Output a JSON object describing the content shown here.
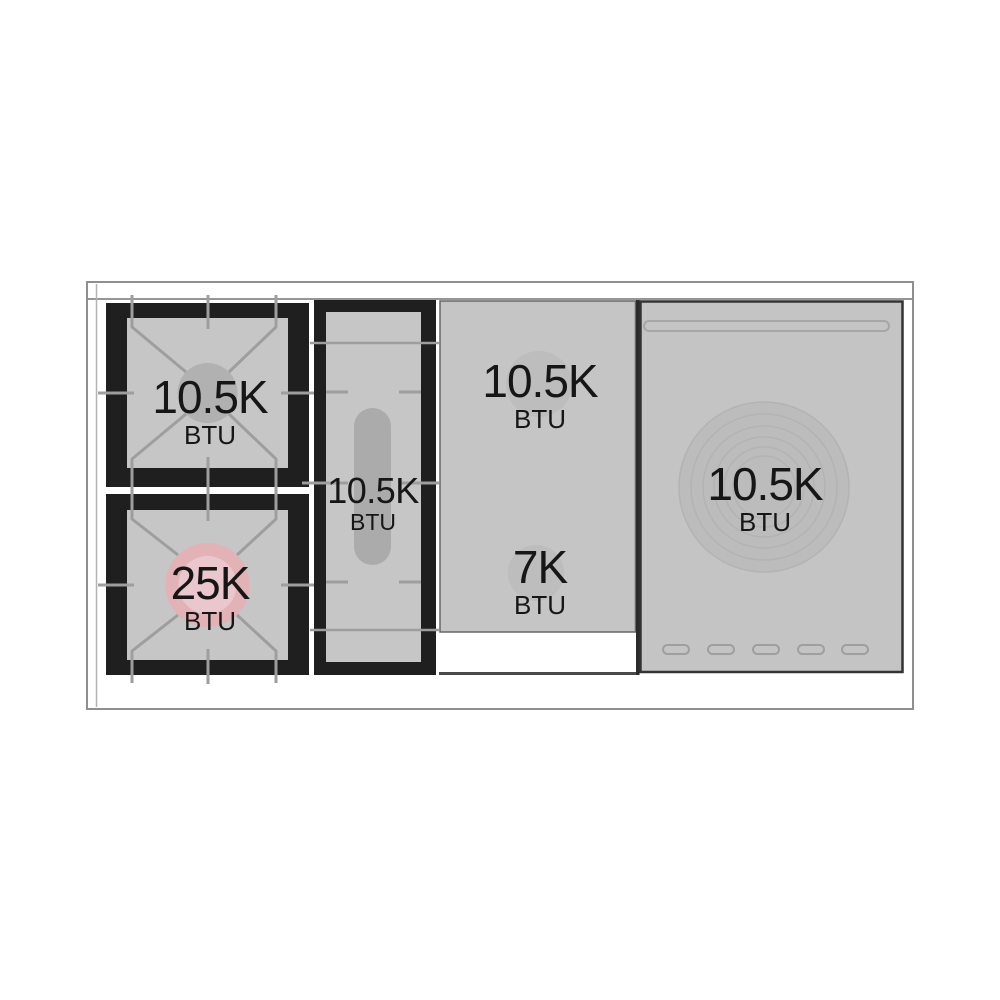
{
  "diagram": {
    "type": "range-cooktop-top-view",
    "burners": [
      {
        "id": "top-left-gas-burner",
        "value": "10.5K",
        "unit": "BTU"
      },
      {
        "id": "bottom-left-power-burner",
        "value": "25K",
        "unit": "BTU"
      },
      {
        "id": "center-oval-burner",
        "value": "10.5K",
        "unit": "BTU"
      },
      {
        "id": "griddle-rear-burner",
        "value": "10.5K",
        "unit": "BTU"
      },
      {
        "id": "griddle-front-burner",
        "value": "7K",
        "unit": "BTU"
      },
      {
        "id": "french-top-burner",
        "value": "10.5K",
        "unit": "BTU"
      }
    ],
    "colors": {
      "power_burner_highlight": "#e2b2b7",
      "power_burner_inner": "#eed3d7",
      "grate_black": "#1f1f1f",
      "surface_gray": "#c6c6c6",
      "line_gray": "#9e9e9e"
    }
  }
}
